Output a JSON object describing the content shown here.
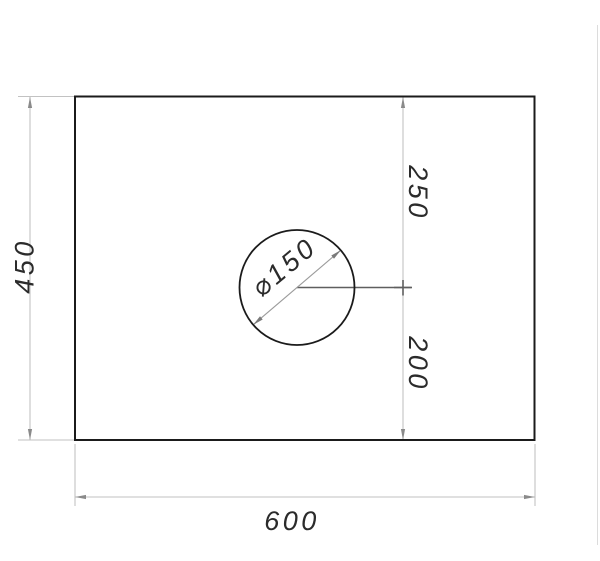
{
  "drawing": {
    "type": "technical-drawing",
    "part": "rectangular-plate-with-hole",
    "dimensions": {
      "height": "450",
      "width": "600",
      "offset_top": "250",
      "offset_bottom": "200",
      "hole_diameter": "⌀150"
    },
    "colors": {
      "outline": "#1b1b1b",
      "dimension_line": "#c2c2c2",
      "dimension_arrow": "#8a8a8a",
      "leader_line": "#5f5f5f",
      "dimension_text": "#2b2b2b",
      "canvas_edge": "#dcdcdc"
    }
  }
}
